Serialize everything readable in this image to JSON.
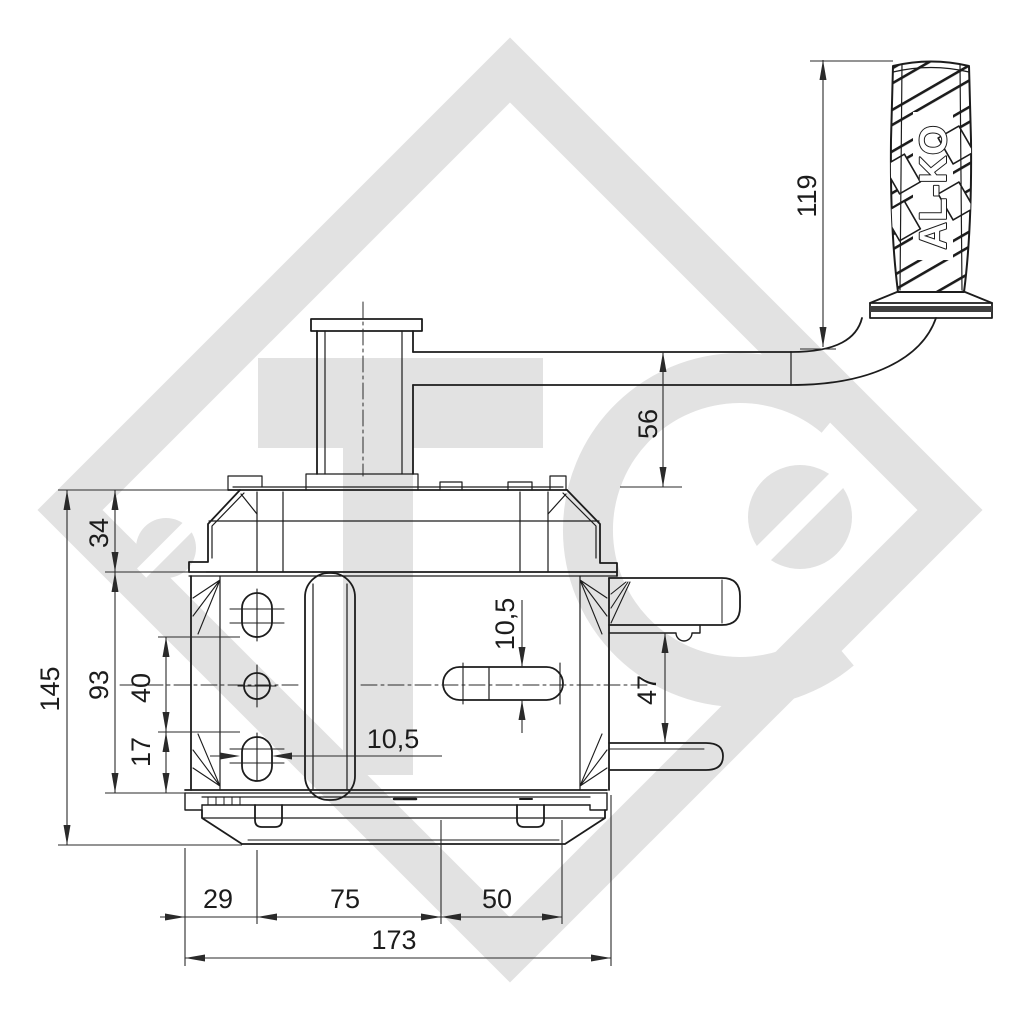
{
  "brand": {
    "grip_label": "AL-KO"
  },
  "dimensions": {
    "handle_grip_length": "119",
    "crank_arm_offset": "56",
    "drum_housing_height": "34",
    "overall_height": "145",
    "side_plate_height": "93",
    "hole_spacing_upper": "40",
    "hole_spacing_lower": "17",
    "left_slot_width": "10,5",
    "right_slot_height": "10,5",
    "bracket_plate_gap": "47",
    "base_offset_left": "29",
    "hole_to_slot_distance": "75",
    "slot_length": "50",
    "overall_width": "173"
  },
  "colors": {
    "line": "#1c1c1c",
    "dimension": "#2a2a2a",
    "watermark": "#e2e2e2",
    "background": "#ffffff",
    "grip_band": "#3f3f3f"
  }
}
